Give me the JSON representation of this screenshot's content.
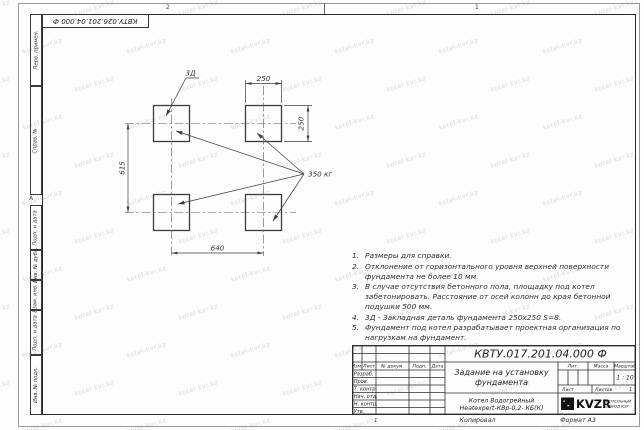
{
  "watermark": {
    "text": "kotel-kvr.kz"
  },
  "sheet": {
    "zone_top_left": "2",
    "zone_top_right": "1",
    "zone_left": "А",
    "top_stamp": "КВТУ.026.201.04.000 Ф",
    "margin_top": [
      {
        "label": "Перв. примен."
      },
      {
        "label": "Справ. №"
      }
    ],
    "margin_bottom": [
      {
        "label": "Подп. и дата"
      },
      {
        "label": "Инв. № дубл."
      },
      {
        "label": "Взам. инв. №"
      },
      {
        "label": "Подп. и дата"
      },
      {
        "label": "Инв. № подл."
      }
    ],
    "fold_mark": "1",
    "copied": "Копировал",
    "format": "Формат А3"
  },
  "drawing": {
    "detail_label": "3Д",
    "load_label": "350 кг",
    "dim_top": "250",
    "dim_right": "250",
    "dim_left": "615",
    "dim_bottom": "640"
  },
  "notes": [
    {
      "num": "1.",
      "text": "Размеры для справки."
    },
    {
      "num": "2.",
      "text": "Отклонение от горизонтального уровня верхней поверхности фундамента не более 10 мм."
    },
    {
      "num": "3.",
      "text": "В случае отсутствия бетонного пола, площадку под котел забетонировать. Расстояние от осей колонн до края бетонной подушки 500 мм."
    },
    {
      "num": "4.",
      "text": "3Д - Закладная деталь фундамента 250х250 S=8."
    },
    {
      "num": "5.",
      "text": "Фундамент под котел разрабатывает проектная организация по нагрузкам на фундамент."
    }
  ],
  "title_block": {
    "doc_number": "КВТУ.017.201.04.000 Ф",
    "title_line1": "Задание на установку",
    "title_line2": "фундамента",
    "header_cols": [
      "Изм.",
      "Лист",
      "№ докум.",
      "Подп.",
      "Дата"
    ],
    "rows": [
      "Разраб.",
      "Пров.",
      "Т. контр.",
      "Нач. отд.",
      "Н. контр.",
      "Утв."
    ],
    "lit_label": "Лит.",
    "mass_label": "Масса",
    "scale_label": "Масштаб",
    "scale_value": "1 : 10",
    "sheet_label": "Лист",
    "sheets_label": "Листов",
    "sheets_value": "1",
    "product_line1": "Котел Водогрейный",
    "product_line2": "Heatexpert-КВр-0,2- КБ(К)",
    "logo_text": "KVZR",
    "logo_sub1": "КОТЕЛЬНЫЙ",
    "logo_sub2": "ЗАВОД КЗР"
  }
}
